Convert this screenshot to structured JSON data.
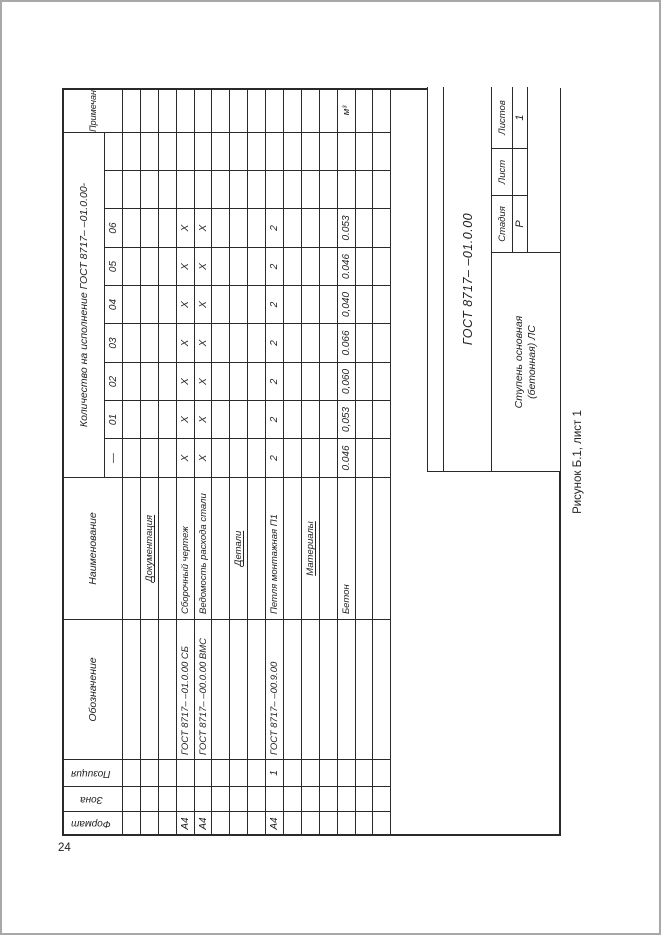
{
  "page": {
    "number": "24",
    "caption": "Рисунок Б.1, лист 1"
  },
  "spec_table": {
    "headers": {
      "format": "Формат",
      "zone": "Зона",
      "position": "Позиция",
      "designation": "Обозначение",
      "name": "Наименование",
      "quantity": "Количество на исполнение ГОСТ 8717– –01.0.00-",
      "note": "Примечание",
      "executions": [
        "—",
        "01",
        "02",
        "03",
        "04",
        "05",
        "06",
        "",
        ""
      ]
    },
    "rows": [
      {
        "format": "",
        "zone": "",
        "pos": "",
        "designation": "",
        "name": "",
        "section": false,
        "values": [
          "",
          "",
          "",
          "",
          "",
          "",
          "",
          "",
          ""
        ],
        "note": ""
      },
      {
        "format": "",
        "zone": "",
        "pos": "",
        "designation": "",
        "name": "Документация",
        "section": true,
        "values": [
          "",
          "",
          "",
          "",
          "",
          "",
          "",
          "",
          ""
        ],
        "note": ""
      },
      {
        "format": "",
        "zone": "",
        "pos": "",
        "designation": "",
        "name": "",
        "section": false,
        "values": [
          "",
          "",
          "",
          "",
          "",
          "",
          "",
          "",
          ""
        ],
        "note": ""
      },
      {
        "format": "А4",
        "zone": "",
        "pos": "",
        "designation": "ГОСТ 8717– –01.0.00 СБ",
        "name": "Сборочный чертеж",
        "section": false,
        "values": [
          "X",
          "X",
          "X",
          "X",
          "X",
          "X",
          "X",
          "",
          ""
        ],
        "note": ""
      },
      {
        "format": "А4",
        "zone": "",
        "pos": "",
        "designation": "ГОСТ 8717– –00.0.00 ВМС",
        "name": "Ведомость расхода стали",
        "section": false,
        "values": [
          "X",
          "X",
          "X",
          "X",
          "X",
          "X",
          "X",
          "",
          ""
        ],
        "note": ""
      },
      {
        "format": "",
        "zone": "",
        "pos": "",
        "designation": "",
        "name": "",
        "section": false,
        "values": [
          "",
          "",
          "",
          "",
          "",
          "",
          "",
          "",
          ""
        ],
        "note": ""
      },
      {
        "format": "",
        "zone": "",
        "pos": "",
        "designation": "",
        "name": "Детали",
        "section": true,
        "values": [
          "",
          "",
          "",
          "",
          "",
          "",
          "",
          "",
          ""
        ],
        "note": ""
      },
      {
        "format": "",
        "zone": "",
        "pos": "",
        "designation": "",
        "name": "",
        "section": false,
        "values": [
          "",
          "",
          "",
          "",
          "",
          "",
          "",
          "",
          ""
        ],
        "note": ""
      },
      {
        "format": "А4",
        "zone": "",
        "pos": "1",
        "designation": "ГОСТ 8717– –00.9.00",
        "name": "Петля монтажная П1",
        "section": false,
        "values": [
          "2",
          "2",
          "2",
          "2",
          "2",
          "2",
          "2",
          "",
          ""
        ],
        "note": ""
      },
      {
        "format": "",
        "zone": "",
        "pos": "",
        "designation": "",
        "name": "",
        "section": false,
        "values": [
          "",
          "",
          "",
          "",
          "",
          "",
          "",
          "",
          ""
        ],
        "note": ""
      },
      {
        "format": "",
        "zone": "",
        "pos": "",
        "designation": "",
        "name": "Материалы",
        "section": true,
        "values": [
          "",
          "",
          "",
          "",
          "",
          "",
          "",
          "",
          ""
        ],
        "note": ""
      },
      {
        "format": "",
        "zone": "",
        "pos": "",
        "designation": "",
        "name": "",
        "section": false,
        "values": [
          "",
          "",
          "",
          "",
          "",
          "",
          "",
          "",
          ""
        ],
        "note": ""
      },
      {
        "format": "",
        "zone": "",
        "pos": "",
        "designation": "",
        "name": "Бетон",
        "section": false,
        "values": [
          "0.046",
          "0,053",
          "0,060",
          "0.066",
          "0,040",
          "0.046",
          "0.053",
          "",
          ""
        ],
        "note": "м³"
      },
      {
        "format": "",
        "zone": "",
        "pos": "",
        "designation": "",
        "name": "",
        "section": false,
        "values": [
          "",
          "",
          "",
          "",
          "",
          "",
          "",
          "",
          ""
        ],
        "note": ""
      },
      {
        "format": "",
        "zone": "",
        "pos": "",
        "designation": "",
        "name": "",
        "section": false,
        "values": [
          "",
          "",
          "",
          "",
          "",
          "",
          "",
          "",
          ""
        ],
        "note": ""
      }
    ]
  },
  "title_block": {
    "designation": "ГОСТ 8717– –01.0.00",
    "name_line1": "Ступень основная",
    "name_line2": "(бетонная) ЛС",
    "stage_label": "Стадия",
    "stage_value": "Р",
    "sheet_label": "Лист",
    "sheet_value": "",
    "sheets_label": "Листов",
    "sheets_value": "1"
  }
}
